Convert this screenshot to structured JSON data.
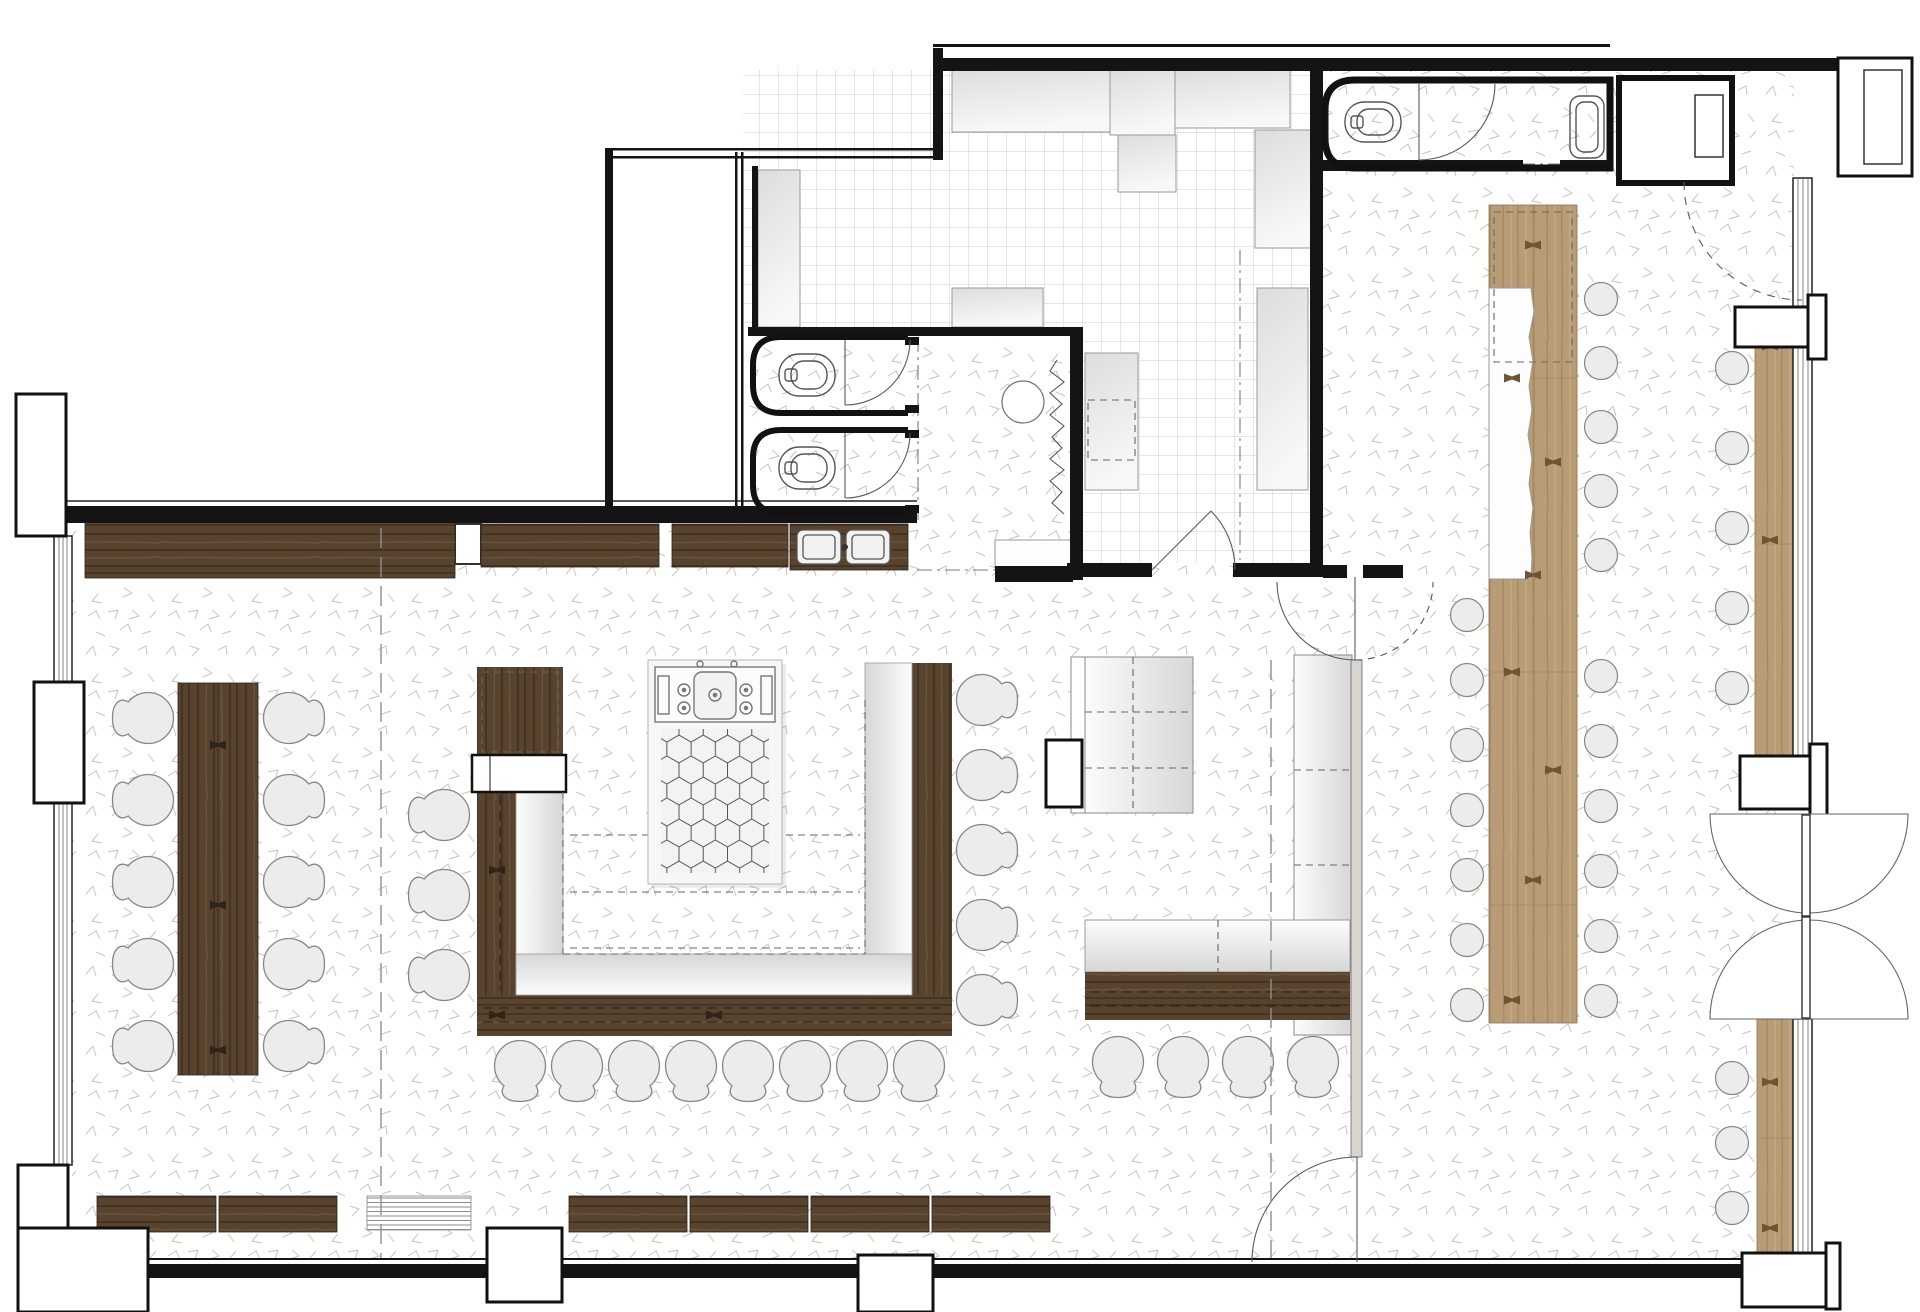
{
  "colors": {
    "wall": "#141414",
    "walnut_dark": "#57432e",
    "walnut_mid": "#6a543c",
    "walnut_streak": "#3d2e1f",
    "oak": "#b89c75",
    "oak_streak": "#a1865e",
    "oak_hi": "#c7ad86",
    "oak_joint": "#6f5436",
    "cushion_hi": "#fcfcfc",
    "cushion_lo": "#d7d7d7",
    "counter_hi": "#f8f8f8",
    "counter_lo": "#dddddd",
    "speckle": "#c8c5c1",
    "tile": "#cccccc",
    "seat_fill": "#ececec",
    "seat_stroke": "#878787",
    "partition": "#d8d4cf"
  },
  "plan": {
    "chair_groups": [
      {
        "name": "left-table-west",
        "rot": 90,
        "x": 148,
        "ys": [
          718,
          800,
          882,
          964,
          1046
        ]
      },
      {
        "name": "left-table-east",
        "rot": 270,
        "x": 289,
        "ys": [
          718,
          800,
          882,
          964,
          1046
        ]
      },
      {
        "name": "u-booth-west",
        "rot": 90,
        "x": 444,
        "ys": [
          815,
          895,
          975
        ]
      },
      {
        "name": "u-booth-east",
        "rot": 270,
        "x": 982,
        "ys": [
          700,
          775,
          850,
          925,
          1000
        ]
      },
      {
        "name": "u-booth-south",
        "rot": 0,
        "y": 1066,
        "xs": [
          520,
          577,
          634,
          691,
          748,
          805,
          862,
          919
        ]
      },
      {
        "name": "lounge-bench-south",
        "rot": 0,
        "y": 1062,
        "xs": [
          1118,
          1183,
          1248,
          1313
        ]
      }
    ],
    "stool_groups": [
      {
        "name": "bar-west",
        "x": 1467,
        "ys": [
          615,
          680,
          745,
          810,
          875,
          940,
          1005
        ]
      },
      {
        "name": "bar-east",
        "x": 1601,
        "ys": [
          299,
          363,
          427,
          491,
          555,
          676,
          741,
          806,
          871,
          936,
          1001
        ]
      },
      {
        "name": "window-bench-upper",
        "x": 1732,
        "ys": [
          368,
          448,
          528,
          608,
          688
        ]
      },
      {
        "name": "window-bench-lower",
        "x": 1732,
        "ys": [
          1078,
          1143,
          1208
        ]
      }
    ],
    "wall_benches": [
      [
        97,
        1196,
        119,
        36
      ],
      [
        219,
        1196,
        118,
        36
      ],
      [
        569,
        1196,
        118,
        36
      ],
      [
        690,
        1196,
        118,
        36
      ],
      [
        811,
        1196,
        118,
        36
      ],
      [
        932,
        1196,
        118,
        36
      ]
    ],
    "top_bench_segments": [
      [
        85,
        522,
        370,
        56
      ],
      [
        481,
        524,
        178,
        43
      ],
      [
        672,
        524,
        116,
        43
      ]
    ],
    "kitchen_counters": [
      [
        952,
        70,
        158,
        62
      ],
      [
        1110,
        70,
        65,
        65
      ],
      [
        1118,
        135,
        58,
        57
      ],
      [
        1175,
        70,
        115,
        58
      ],
      [
        758,
        170,
        42,
        157
      ],
      [
        1085,
        353,
        53,
        137
      ],
      [
        1257,
        288,
        51,
        202
      ],
      [
        1255,
        130,
        57,
        118
      ],
      [
        952,
        288,
        91,
        39
      ]
    ],
    "oak_joints_bar": [
      [
        1533,
        245
      ],
      [
        1512,
        378
      ],
      [
        1553,
        462
      ],
      [
        1533,
        575
      ],
      [
        1512,
        672
      ],
      [
        1553,
        770
      ],
      [
        1533,
        880
      ],
      [
        1512,
        1000
      ]
    ],
    "oak_joints_bench": [
      [
        1770,
        346
      ],
      [
        1770,
        540
      ],
      [
        1770,
        1082
      ],
      [
        1770,
        1228
      ]
    ],
    "walnut_joints": [
      [
        218,
        745
      ],
      [
        218,
        905
      ],
      [
        218,
        1050
      ],
      [
        497,
        870
      ],
      [
        497,
        1015
      ],
      [
        714,
        1015
      ]
    ]
  }
}
